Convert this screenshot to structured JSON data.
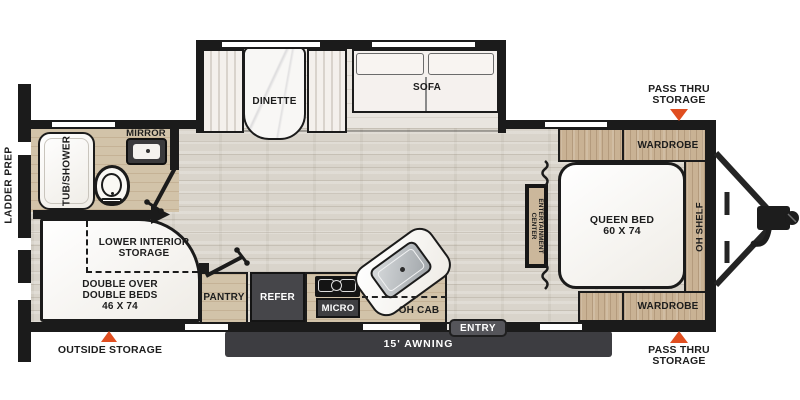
{
  "plan": {
    "exterior": {
      "ladder_prep": "LADDER PREP",
      "outside_storage": "OUTSIDE STORAGE",
      "pass_thru_top_line1": "PASS THRU",
      "pass_thru_top_line2": "STORAGE",
      "pass_thru_bottom_line1": "PASS THRU",
      "pass_thru_bottom_line2": "STORAGE",
      "awning": "15' AWNING",
      "entry": "ENTRY"
    },
    "bathroom": {
      "tub_shower": "TUB/SHOWER",
      "mirror": "MIRROR"
    },
    "bunk_room": {
      "lower_interior_line1": "LOWER INTERIOR",
      "lower_interior_line2": "STORAGE",
      "double_beds_line1": "DOUBLE OVER",
      "double_beds_line2": "DOUBLE BEDS",
      "double_beds_line3": "46 X 74"
    },
    "kitchen": {
      "pantry": "PANTRY",
      "refer": "REFER",
      "micro": "MICRO",
      "oh_cab": "OH CAB"
    },
    "living_area": {
      "dinette": "DINETTE",
      "sofa": "SOFA"
    },
    "bedroom": {
      "queen_bed_line1": "QUEEN BED",
      "queen_bed_line2": "60 X 74",
      "wardrobe_top": "WARDROBE",
      "wardrobe_bottom": "WARDROBE",
      "oh_shelf": "OH SHELF",
      "entertainment_line1": "ENTERTAINMENT",
      "entertainment_line2": "CENTER"
    },
    "colors": {
      "marker": "#e04e20",
      "wall": "#1b1b1b",
      "cabinet_wood": "#c9b294",
      "dark_fixture": "#46464a"
    }
  }
}
